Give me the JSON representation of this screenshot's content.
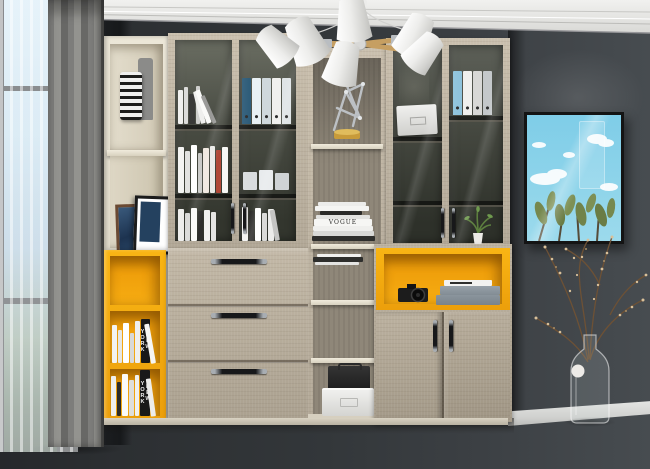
{
  "scene": {
    "type": "interior-photograph",
    "description": "Modern study room: light-oak wall bookcase with glass display doors full of binders and books, cream open shelves, yellow accent cubbies, three drawers and a two-door cabinet; white cone chandelier; grey curtains beside a bright window; framed sky-and-cactus artwork on a dark grey wall; glass bottle vase with dried branches on grey plank flooring.",
    "objects": [
      "window",
      "sheer-curtain",
      "drape-curtain",
      "crown-molding",
      "chandelier",
      "bookcase",
      "glass-display-cabinet",
      "binders",
      "books",
      "magazine-stack",
      "wire-sculpture",
      "picture-frames",
      "striped-vase",
      "grey-vase",
      "yellow-cubbies",
      "drawer-unit",
      "camera",
      "storage-boxes",
      "double-door-cabinet",
      "potted-plant",
      "wall-art",
      "dried-branches",
      "glass-bottle-vase",
      "baseboard",
      "wood-floor"
    ]
  },
  "texts": {
    "spine_vogue": "VOGUE",
    "spine_new_york_upper": "NEW YORK",
    "spine_new_york_lower": "NEW YORK"
  },
  "palette": {
    "wall": "#3c4044",
    "ceiling": "#eeeeec",
    "wood": "#c6bba8",
    "cream": "#e8e3d6",
    "accent_yellow": "#f3a60e",
    "floor": "#989896",
    "curtain_grey": "#8b8b89",
    "art_sky": "#85cfe6",
    "art_frame": "#141414"
  }
}
